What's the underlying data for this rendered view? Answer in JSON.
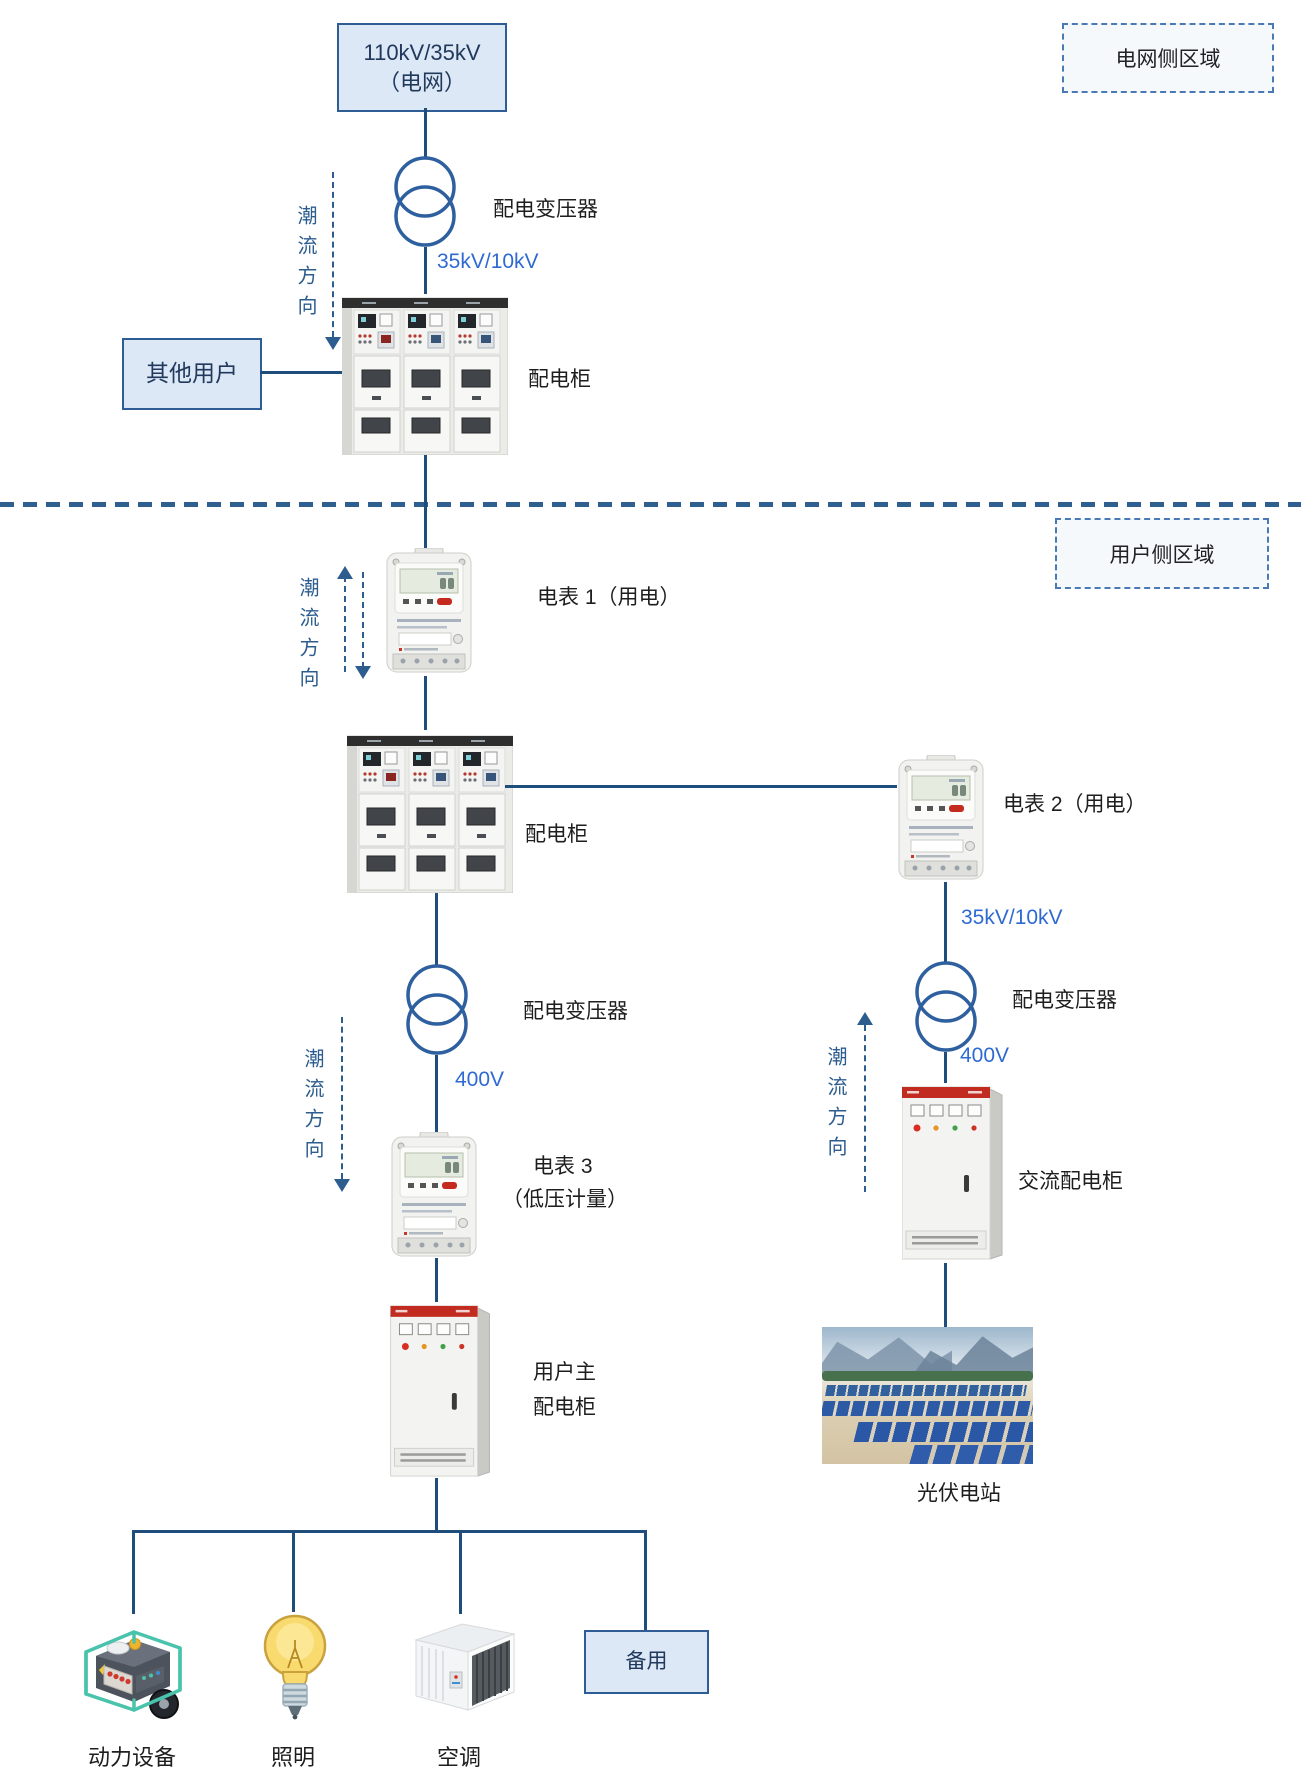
{
  "area_labels": {
    "grid": "电网侧区域",
    "user": "用户侧区域"
  },
  "grid_box": {
    "line1": "110kV/35kV",
    "line2": "（电网）"
  },
  "other_users_label": "其他用户",
  "flow_direction_label": "潮流方向",
  "grid_section": {
    "transformer_label": "配电变压器",
    "voltage": "35kV/10kV",
    "cabinet_label": "配电柜"
  },
  "user_section": {
    "meter1_label": "电表 1（用电）",
    "cabinet_label": "配电柜",
    "meter2_label": "电表 2（用电）",
    "pv_branch": {
      "voltage_hv": "35kV/10kV",
      "transformer_label": "配电变压器",
      "voltage_lv": "400V",
      "ac_cabinet_label": "交流配电柜",
      "pv_station_label": "光伏电站"
    },
    "load_branch": {
      "transformer_label": "配电变压器",
      "voltage_lv": "400V",
      "meter3_line1": "电表 3",
      "meter3_line2": "（低压计量）",
      "main_cabinet_line1": "用户主",
      "main_cabinet_line2": "配电柜"
    },
    "loads": {
      "power_equipment": "动力设备",
      "lighting": "照明",
      "air_conditioning": "空调",
      "backup": "备用"
    }
  },
  "colors": {
    "connector_line": "#1f4e7c",
    "voltage_text": "#2f6ad2",
    "flow_annotation": "#2d5d8f",
    "node_box_fill": "#dce8f5",
    "node_box_border": "#2e5d96",
    "area_box_border": "#4a7ab5",
    "cabinet_red_band": "#c22b20"
  }
}
